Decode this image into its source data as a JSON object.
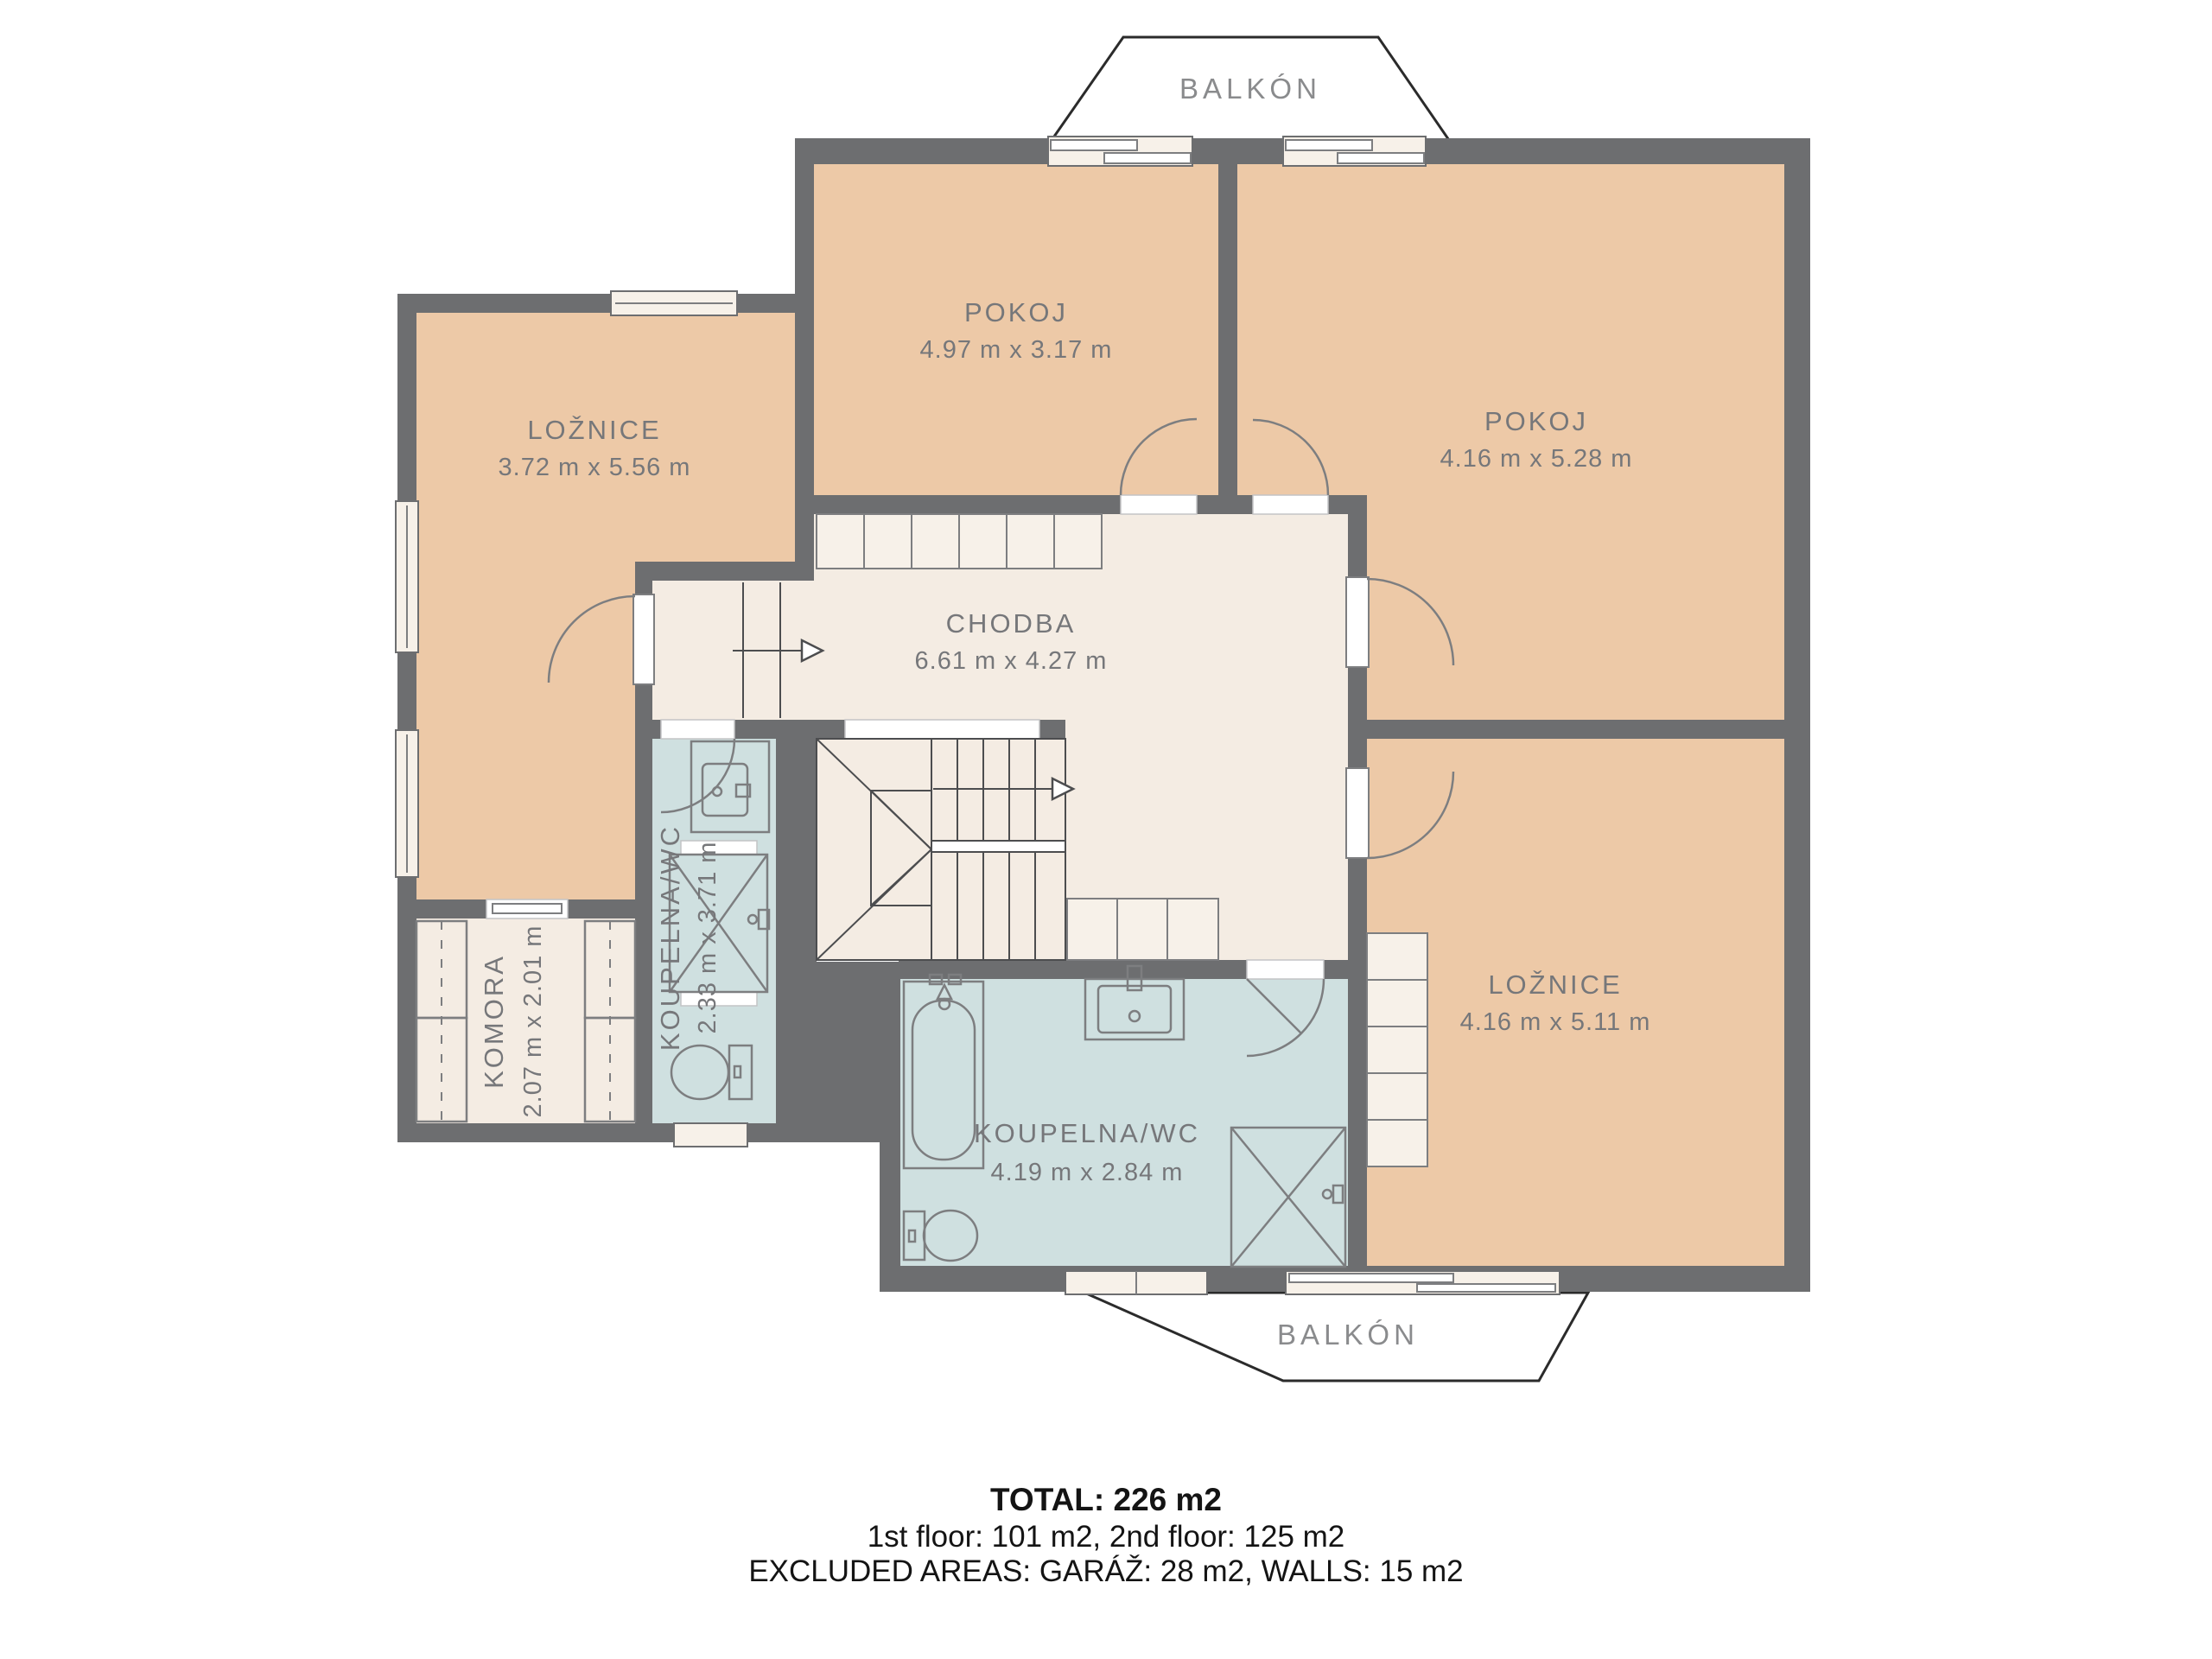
{
  "colors": {
    "wall": "#6d6e70",
    "room_peach": "#edc9a7",
    "room_cream": "#f4ece3",
    "room_blue": "#cfe0e0",
    "line": "#7d7e80",
    "label": "#76777a",
    "balcony_label": "#8a8b8d",
    "footer": "#141414",
    "window_fill": "#f7f1e9",
    "outline_dark": "#4c4d4f",
    "balcony_stroke": "#2b2b2b"
  },
  "balcony_top": {
    "label": "BALKÓN"
  },
  "balcony_bottom": {
    "label": "BALKÓN"
  },
  "rooms": {
    "pokoj_top": {
      "name": "POKOJ",
      "dims": "4.97 m x 3.17 m"
    },
    "pokoj_right": {
      "name": "POKOJ",
      "dims": "4.16 m x 5.28 m"
    },
    "loznice_left": {
      "name": "LOŽNICE",
      "dims": "3.72 m x 5.56 m"
    },
    "chodba": {
      "name": "CHODBA",
      "dims": "6.61 m x 4.27 m"
    },
    "koupelna_left": {
      "name": "KOUPELNA/WC",
      "dims": "2.33 m x 3.71 m"
    },
    "komora": {
      "name": "KOMORA",
      "dims": "2.07 m x 2.01 m"
    },
    "loznice_right": {
      "name": "LOŽNICE",
      "dims": "4.16 m x 5.11 m"
    },
    "koupelna_bottom": {
      "name": "KOUPELNA/WC",
      "dims": "4.19 m x 2.84 m"
    }
  },
  "footer": {
    "total": "TOTAL: 226 m2",
    "floors": "1st floor: 101 m2, 2nd floor: 125 m2",
    "excluded": "EXCLUDED AREAS: GARÁŽ: 28 m2, WALLS: 15 m2"
  }
}
